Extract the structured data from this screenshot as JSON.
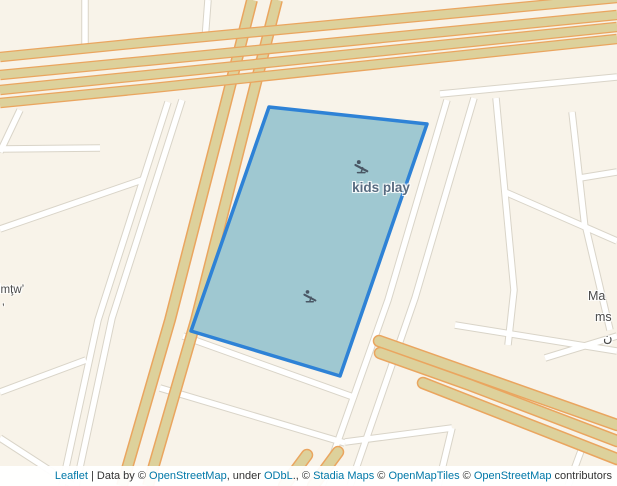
{
  "map": {
    "size": {
      "width": 617,
      "height": 486
    },
    "colors": {
      "background": "#f8f3e9",
      "minor_road_fill": "#ffffff",
      "minor_road_casing": "#d9d4c8",
      "major_road_fill": "#ddd19b",
      "major_road_casing": "#eaa55f",
      "selection_fill": "#9fc8d1",
      "selection_stroke": "#2e82d6",
      "poi_label_color": "#576b80",
      "place_label_color": "#4a4a4a",
      "icon_color": "#4a5765"
    },
    "roads": [
      {
        "name": "roads-minor",
        "fill": "#ffffff",
        "casing": "#d9d4c8",
        "width": 5.5,
        "casing_width": 7.5,
        "cap": "butt",
        "paths": [
          "M 85,0 L 85,52",
          "M 208,0 L 205,40",
          "M 20,110 L 0,152",
          "M 0,149 L 100,148",
          "M 168,102 L 98,320 L 62,486",
          "M 182,100 L 112,318 L 76,486",
          "M 0,229 L 142,180",
          "M 0,392 L 86,360",
          "M 0,438 L 74,486",
          "M 183,336 L 356,398",
          "M 160,388 L 345,443",
          "M 447,100 L 388,300 L 322,486",
          "M 474,98 L 415,298 L 350,486",
          "M 440,94 L 617,77",
          "M 496,98 L 514,290 L 508,345",
          "M 505,192 L 617,241",
          "M 572,112 L 585,228",
          "M 580,178 L 617,172",
          "M 586,228 L 610,330",
          "M 455,325 L 617,351",
          "M 545,358 L 617,336",
          "M 345,442 L 452,428",
          "M 452,428 L 438,486",
          "M 585,440 L 568,486"
        ]
      },
      {
        "name": "roads-avenue",
        "fill": "#ddd19b",
        "casing": "#eaa55f",
        "width": 9,
        "casing_width": 12,
        "cap": "butt",
        "paths": [
          "M 252,0 L 222,118 L 170,320 L 122,486",
          "M 277,0 L 247,118 L 196,320 L 148,486"
        ]
      },
      {
        "name": "roads-highway",
        "fill": "#ddd19b",
        "casing": "#eaa55f",
        "width": 8,
        "casing_width": 10.5,
        "cap": "butt",
        "paths": [
          "M 0,57 C 210,36 430,14 617,-2",
          "M 0,75 C 210,55 430,33 617,15",
          "M 0,90 C 210,69 430,46 617,27",
          "M 0,103 C 210,83 430,59 617,39"
        ]
      },
      {
        "name": "roads-ramp-fan",
        "fill": "#ddd19b",
        "casing": "#eaa55f",
        "width": 9.5,
        "casing_width": 12.5,
        "cap": "round",
        "paths": [
          "M 379,341 L 617,425",
          "M 380,353 L 470,385 L 617,441",
          "M 423,383 L 617,459",
          "M 284,486 L 307,455",
          "M 313,486 L 338,452"
        ]
      }
    ],
    "selection": {
      "feature": "kids play area",
      "points": "269,107 427,124 340,376 191,331",
      "stroke_width": 3.5
    },
    "icons": [
      {
        "name": "playground-icon",
        "x": 362,
        "y": 167,
        "size": 16
      },
      {
        "name": "playground-icon",
        "x": 310,
        "y": 296,
        "size": 15
      }
    ],
    "labels": [
      {
        "name": "kids-play-label",
        "text": "kids play",
        "x": 381,
        "y": 180,
        "size": 13.5,
        "weight": 600,
        "color": "#576b80",
        "align": "center"
      },
      {
        "name": "street-label-partial-left",
        "text": "lmţw’",
        "x": -2,
        "y": 284,
        "size": 11.5,
        "weight": 400,
        "color": "#4a4a4a",
        "align": "left"
      },
      {
        "name": "stray-mark-label",
        "text": "’",
        "x": 2,
        "y": 301,
        "size": 12,
        "weight": 400,
        "color": "#4a4a4a",
        "align": "left"
      },
      {
        "name": "place-label-partial-ma",
        "text": "Ma",
        "x": 588,
        "y": 289,
        "size": 12.5,
        "weight": 400,
        "color": "#4a4a4a",
        "align": "left"
      },
      {
        "name": "place-label-partial-ms",
        "text": "ms",
        "x": 595,
        "y": 310,
        "size": 12.5,
        "weight": 400,
        "color": "#4a4a4a",
        "align": "left"
      },
      {
        "name": "place-label-partial-arabic",
        "text": "ن",
        "x": 603,
        "y": 330,
        "size": 13,
        "weight": 400,
        "color": "#4a4a4a",
        "align": "left"
      }
    ]
  },
  "attribution": {
    "link_color": "#0078a8",
    "text_color": "#333333",
    "segments": [
      {
        "text": "Leaflet",
        "link": true
      },
      {
        "text": " | Data by © ",
        "link": false
      },
      {
        "text": "OpenStreetMap",
        "link": true
      },
      {
        "text": ", under ",
        "link": false
      },
      {
        "text": "ODbL",
        "link": true
      },
      {
        "text": "., © ",
        "link": false
      },
      {
        "text": "Stadia Maps",
        "link": true
      },
      {
        "text": " © ",
        "link": false
      },
      {
        "text": "OpenMapTiles",
        "link": true
      },
      {
        "text": " © ",
        "link": false
      },
      {
        "text": "OpenStreetMap",
        "link": true
      },
      {
        "text": " contributors",
        "link": false
      }
    ]
  }
}
